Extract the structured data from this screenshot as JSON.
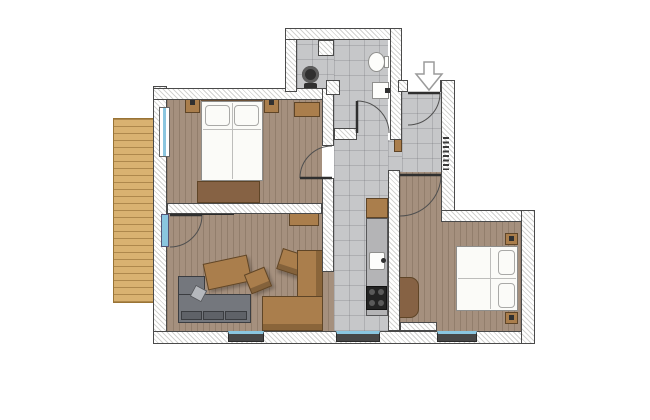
{
  "canvas": {
    "width": 650,
    "height": 420
  },
  "content_type": "apartment-floor-plan-drawing",
  "visible_text": [],
  "colors": {
    "wall_line": "#4a4a4a",
    "wall_hatch": "#d2d2d0",
    "wood": "#a5907e",
    "balcony": "#d9b271",
    "balcony_line": "#9a7435",
    "tile": "#c6c7c9",
    "tan": "#aa7e4c",
    "tan_dark": "#8a653a",
    "dark_wood": "#866244",
    "outline": "#5f4527",
    "sofa": "#74777d",
    "sofa_dark": "#5f6268",
    "sofa_light": "#b5b8bd",
    "bed": "#fbfbf8",
    "glass": "#8ac6e0",
    "fixture": "#303030",
    "arrow_fill": "#ffffff",
    "arrow_stroke": "#9b9b9b"
  },
  "rooms": [
    {
      "id": "bedroom-1",
      "floor": "wood",
      "furniture": [
        "double-bed",
        "nightstand",
        "nightstand",
        "dresser",
        "wardrobe-chest"
      ]
    },
    {
      "id": "living-room",
      "floor": "wood",
      "furniture": [
        "l-shaped-sofa",
        "coffee-table",
        "armchair",
        "armchair",
        "corner-bench",
        "sideboard",
        "tv-board"
      ]
    },
    {
      "id": "bathroom",
      "floor": "tile",
      "fixtures": [
        "toilet",
        "washbasin",
        "washing-machine"
      ]
    },
    {
      "id": "corridor-kitchen",
      "floor": "tile",
      "fixtures": [
        "kitchen-cabinet",
        "kitchen-counter",
        "kitchen-sink",
        "cooktop"
      ]
    },
    {
      "id": "entry-hall",
      "floor": "tile",
      "fixtures": [
        "entrance-door",
        "entrance-arrow",
        "coat-hooks",
        "closet"
      ]
    },
    {
      "id": "bedroom-2",
      "floor": "wood",
      "furniture": [
        "double-bed",
        "nightstand",
        "nightstand",
        "wardrobe"
      ]
    },
    {
      "id": "balcony",
      "floor": "wood-deck"
    }
  ],
  "openings": {
    "doors": [
      "entrance-door",
      "bathroom-door",
      "bedroom-1-door",
      "bedroom-2-door",
      "balcony-door"
    ],
    "windows": [
      "bedroom-1-left-window",
      "living-room-bottom-window",
      "corridor-bottom-window",
      "bedroom-2-bottom-window"
    ]
  },
  "entry_arrow": {
    "direction": "down",
    "meaning": "entrance"
  }
}
